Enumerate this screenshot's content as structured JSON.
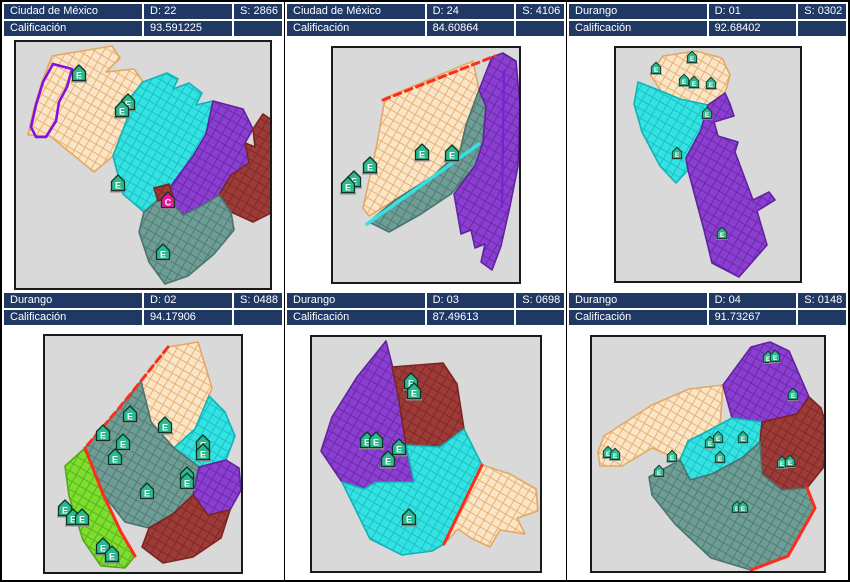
{
  "colors": {
    "header_bg": "#1F3864",
    "header_text": "#FFFFFF",
    "map_bg": "#D9D9D9",
    "frame_border": "#1A1A1A",
    "regions": {
      "wheat": "#FBE5C8",
      "wheat_line": "#E2A963",
      "cyan": "#35E2E2",
      "cyan_line": "#0FB4B8",
      "purple": "#8A3FD0",
      "purple_line": "#62229F",
      "dark_red": "#9C3B38",
      "dark_red_line": "#7A2522",
      "slate_teal": "#6E9D96",
      "slate_teal_line": "#4B746D",
      "green": "#7CDE2E",
      "green_line": "#55A818",
      "highlight_outline": "#8510E0",
      "boundary_red": "#FF2B1B"
    },
    "marker": {
      "E": "#2BB98E",
      "C": "#E8189B",
      "stroke": "#0F3328",
      "letter": "#FFFFFF"
    }
  },
  "panels": [
    {
      "title": "Ciudad de México",
      "district": "D: 22",
      "section": "S: 2866",
      "score_label": "Calificación",
      "score": "93.591225",
      "marker_scale": 1,
      "markers": [
        {
          "x": 63,
          "y": 31,
          "t": "E"
        },
        {
          "x": 112,
          "y": 60,
          "t": "E"
        },
        {
          "x": 106,
          "y": 67,
          "t": "E"
        },
        {
          "x": 102,
          "y": 141,
          "t": "E"
        },
        {
          "x": 152,
          "y": 158,
          "t": "C"
        },
        {
          "x": 147,
          "y": 210,
          "t": "E"
        }
      ]
    },
    {
      "title": "Ciudad de México",
      "district": "D: 24",
      "section": "S: 4106",
      "score_label": "Calificación",
      "score": "84.60864",
      "marker_scale": 1,
      "markers": [
        {
          "x": 89,
          "y": 104,
          "t": "E"
        },
        {
          "x": 119,
          "y": 105,
          "t": "E"
        },
        {
          "x": 37,
          "y": 117,
          "t": "E"
        },
        {
          "x": 21,
          "y": 131,
          "t": "E"
        },
        {
          "x": 15,
          "y": 137,
          "t": "E"
        }
      ]
    },
    {
      "title": "Durango",
      "district": "D: 01",
      "section": "S: 0302",
      "score_label": "Calificación",
      "score": "92.68402",
      "marker_scale": 0.72,
      "markers": [
        {
          "x": 76,
          "y": 9,
          "t": "E"
        },
        {
          "x": 40,
          "y": 20,
          "t": "E"
        },
        {
          "x": 68,
          "y": 32,
          "t": "E"
        },
        {
          "x": 78,
          "y": 34,
          "t": "E"
        },
        {
          "x": 95,
          "y": 35,
          "t": "E"
        },
        {
          "x": 91,
          "y": 65,
          "t": "E"
        },
        {
          "x": 61,
          "y": 105,
          "t": "E"
        },
        {
          "x": 106,
          "y": 185,
          "t": "E"
        }
      ]
    },
    {
      "title": "Durango",
      "district": "D: 02",
      "section": "S: 0488",
      "score_label": "Calificación",
      "score": "94.17906",
      "marker_scale": 1,
      "markers": [
        {
          "x": 85,
          "y": 78,
          "t": "E"
        },
        {
          "x": 120,
          "y": 89,
          "t": "E"
        },
        {
          "x": 58,
          "y": 97,
          "t": "E"
        },
        {
          "x": 78,
          "y": 106,
          "t": "E"
        },
        {
          "x": 70,
          "y": 121,
          "t": "E"
        },
        {
          "x": 158,
          "y": 107,
          "t": "E"
        },
        {
          "x": 158,
          "y": 116,
          "t": "E"
        },
        {
          "x": 142,
          "y": 139,
          "t": "E"
        },
        {
          "x": 142,
          "y": 145,
          "t": "E"
        },
        {
          "x": 102,
          "y": 155,
          "t": "E"
        },
        {
          "x": 20,
          "y": 172,
          "t": "E"
        },
        {
          "x": 28,
          "y": 181,
          "t": "E"
        },
        {
          "x": 37,
          "y": 181,
          "t": "E"
        },
        {
          "x": 58,
          "y": 210,
          "t": "E"
        },
        {
          "x": 67,
          "y": 218,
          "t": "E"
        }
      ]
    },
    {
      "title": "Durango",
      "district": "D: 03",
      "section": "S: 0698",
      "score_label": "Calificación",
      "score": "87.49613",
      "marker_scale": 1,
      "markers": [
        {
          "x": 99,
          "y": 44,
          "t": "E"
        },
        {
          "x": 102,
          "y": 54,
          "t": "E"
        },
        {
          "x": 55,
          "y": 103,
          "t": "E"
        },
        {
          "x": 64,
          "y": 103,
          "t": "E"
        },
        {
          "x": 87,
          "y": 110,
          "t": "E"
        },
        {
          "x": 76,
          "y": 122,
          "t": "E"
        },
        {
          "x": 97,
          "y": 180,
          "t": "E"
        }
      ]
    },
    {
      "title": "Durango",
      "district": "D: 04",
      "section": "S: 0148",
      "score_label": "Calificación",
      "score": "91.73267",
      "marker_scale": 0.72,
      "markers": [
        {
          "x": 176,
          "y": 20,
          "t": "E"
        },
        {
          "x": 183,
          "y": 19,
          "t": "E"
        },
        {
          "x": 201,
          "y": 57,
          "t": "E"
        },
        {
          "x": 16,
          "y": 115,
          "t": "E"
        },
        {
          "x": 23,
          "y": 117,
          "t": "E"
        },
        {
          "x": 80,
          "y": 119,
          "t": "E"
        },
        {
          "x": 118,
          "y": 105,
          "t": "E"
        },
        {
          "x": 126,
          "y": 100,
          "t": "E"
        },
        {
          "x": 151,
          "y": 100,
          "t": "E"
        },
        {
          "x": 128,
          "y": 120,
          "t": "E"
        },
        {
          "x": 67,
          "y": 134,
          "t": "E"
        },
        {
          "x": 190,
          "y": 125,
          "t": "E"
        },
        {
          "x": 198,
          "y": 124,
          "t": "E"
        },
        {
          "x": 145,
          "y": 170,
          "t": "E"
        },
        {
          "x": 151,
          "y": 170,
          "t": "E"
        }
      ]
    }
  ]
}
